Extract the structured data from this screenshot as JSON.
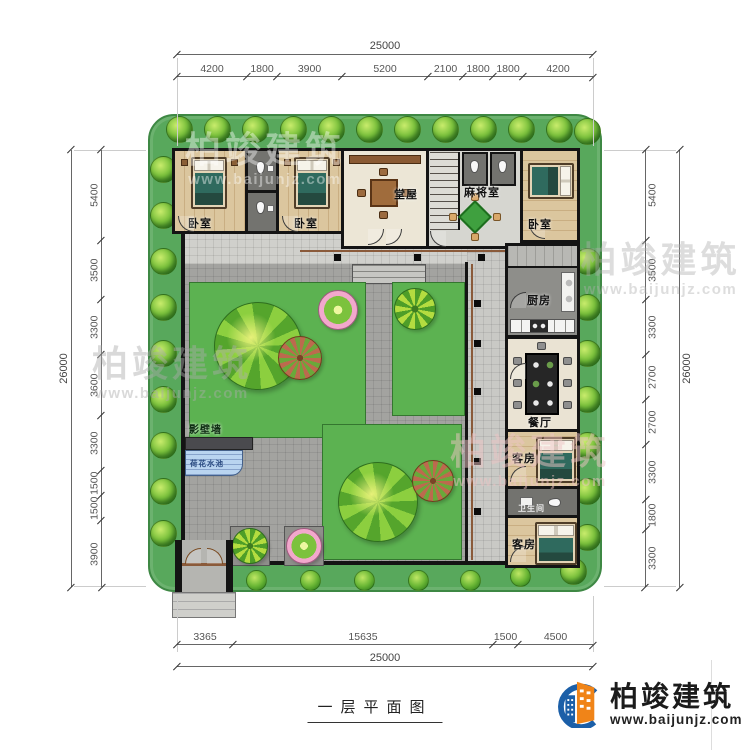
{
  "page": {
    "caption": "一层平面图"
  },
  "logo": {
    "company": "柏竣建筑",
    "website": "www.baijunjz.com"
  },
  "watermark": {
    "text": "柏竣建筑",
    "url": "www.baijunjz.com"
  },
  "dims": {
    "top": {
      "total": "25000",
      "segments": [
        "4200",
        "1800",
        "3900",
        "5200",
        "2100",
        "1800",
        "1800",
        "4200"
      ]
    },
    "bottom": {
      "total": "25000",
      "segments": [
        "3365",
        "15635",
        "1500",
        "4500"
      ]
    },
    "left": {
      "total": "26000",
      "segments": [
        "5400",
        "3500",
        "3300",
        "3600",
        "3300",
        "1500",
        "1500",
        "3900"
      ]
    },
    "right": {
      "total": "26000",
      "segments": [
        "5400",
        "3500",
        "3300",
        "2700",
        "2700",
        "3300",
        "1800",
        "3300"
      ]
    }
  },
  "rooms": {
    "bedroom_left1": "卧室",
    "bedroom_left2": "卧室",
    "hall": "堂屋",
    "mahjong_room": "麻将室",
    "bedroom_right": "卧室",
    "kitchen": "厨房",
    "dining_room": "餐厅",
    "guest_room1": "客房",
    "bathroom": "卫生间",
    "guest_room2": "客房",
    "screen_wall": "影壁墙",
    "lotus_pond": "荷花水池"
  },
  "colors": {
    "plot_green": "#58a85c",
    "lawn_green": "#5cb251",
    "path_grey": "#a3a3a0",
    "wall_black": "#141414",
    "accent_blue": "#1b5fa8",
    "accent_orange": "#f08418"
  }
}
